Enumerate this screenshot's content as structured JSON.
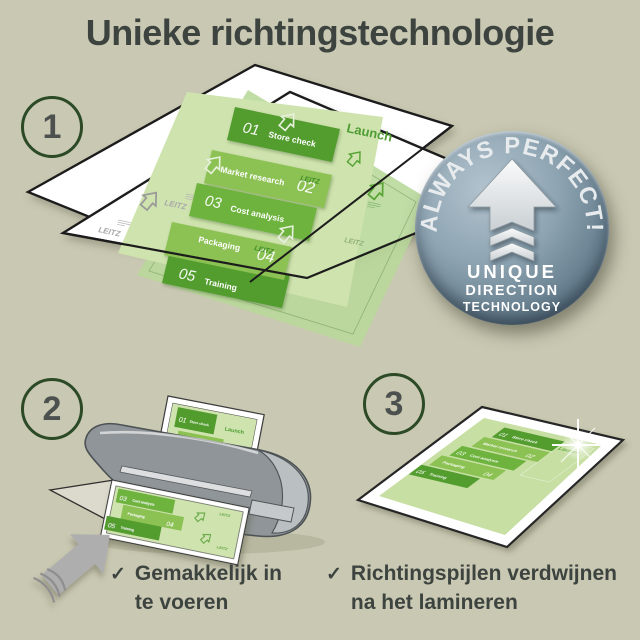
{
  "title": "Unieke richtingstechnologie",
  "steps": {
    "one": "1",
    "two": "2",
    "three": "3"
  },
  "badge": {
    "arc": "ALWAYS PERFECT!",
    "word1": "UNIQUE",
    "word2": "DIRECTION",
    "word3": "TECHNOLOGY"
  },
  "doc": {
    "watermark": "LEITZ",
    "launch": "Launch",
    "rows": [
      {
        "num": "01",
        "label": "Store check"
      },
      {
        "num": "02",
        "label": "Market research"
      },
      {
        "num": "03",
        "label": "Cost analysis"
      },
      {
        "num": "04",
        "label": "Packaging"
      },
      {
        "num": "05",
        "label": "Training"
      }
    ]
  },
  "checklist": {
    "check": "✓",
    "item1": {
      "line1": "Gemakkelijk in",
      "line2": "te voeren"
    },
    "item2": {
      "line1": "Richtingspijlen verdwijnen",
      "line2": "na het lamineren"
    }
  },
  "colors": {
    "background": "#c9c8b2",
    "heading_text": "#3d4440",
    "step_ring_green": "#2c4a26",
    "step_number_gray": "#4c504e",
    "doc_green_dark": "#529c2e",
    "doc_green_mid": "#6db33c",
    "doc_green_light": "#8cc152",
    "doc_page_green": "#cfe3ae",
    "badge_steel_blue": "#7d94a4",
    "laminator_gray": "#8f9598",
    "feed_arrow_gray": "#aeaeae"
  }
}
